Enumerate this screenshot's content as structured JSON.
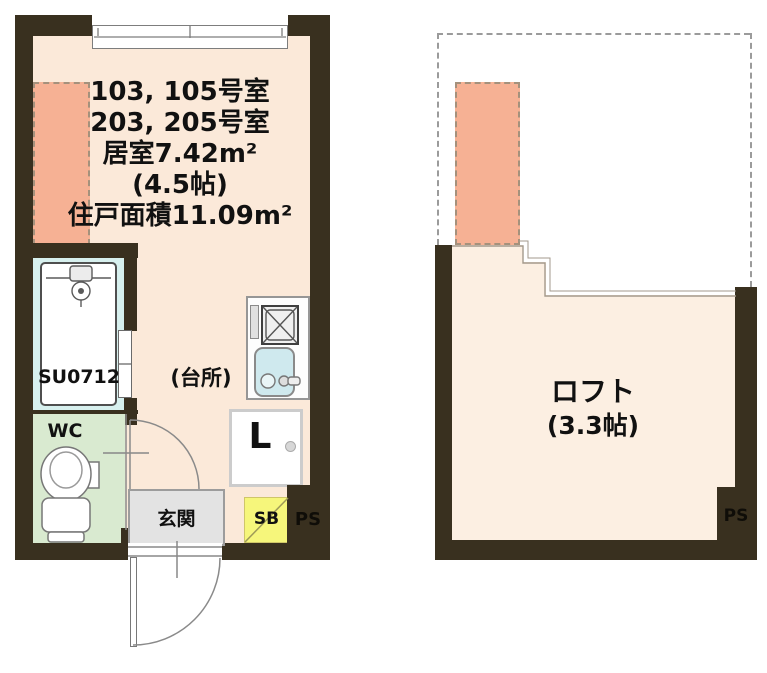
{
  "document": {
    "type": "japanese-apartment-floorplan",
    "plans": [
      "unit-plan",
      "loft-plan"
    ]
  },
  "unit_plan": {
    "title_lines": [
      "103, 105号室",
      "203, 205号室",
      "居室7.42m²",
      "(4.5帖)",
      "住戸面積11.09m²"
    ],
    "labels": {
      "bath_unit": "SU0712",
      "toilet_room": "WC",
      "kitchen": "(台所)",
      "laundry": "L",
      "entrance": "玄関",
      "shoe_box": "SB",
      "pipe_space": "PS"
    }
  },
  "loft_plan": {
    "labels": {
      "loft_name": "ロフト",
      "loft_size": "(3.3帖)",
      "pipe_space": "PS"
    }
  },
  "colors": {
    "wall": "#39301f",
    "unit_floor": "#fbe9d9",
    "loft_floor": "#fcefe2",
    "loft_ladder_area": "#f6b194",
    "bathroom": "#d7f0ee",
    "wc_room": "#d9ead0",
    "entrance": "#e3e3e3",
    "shoe_box": "#f6f67b",
    "sink": "#cfe9ee",
    "line": "#8a8a8a",
    "text": "#111111"
  }
}
